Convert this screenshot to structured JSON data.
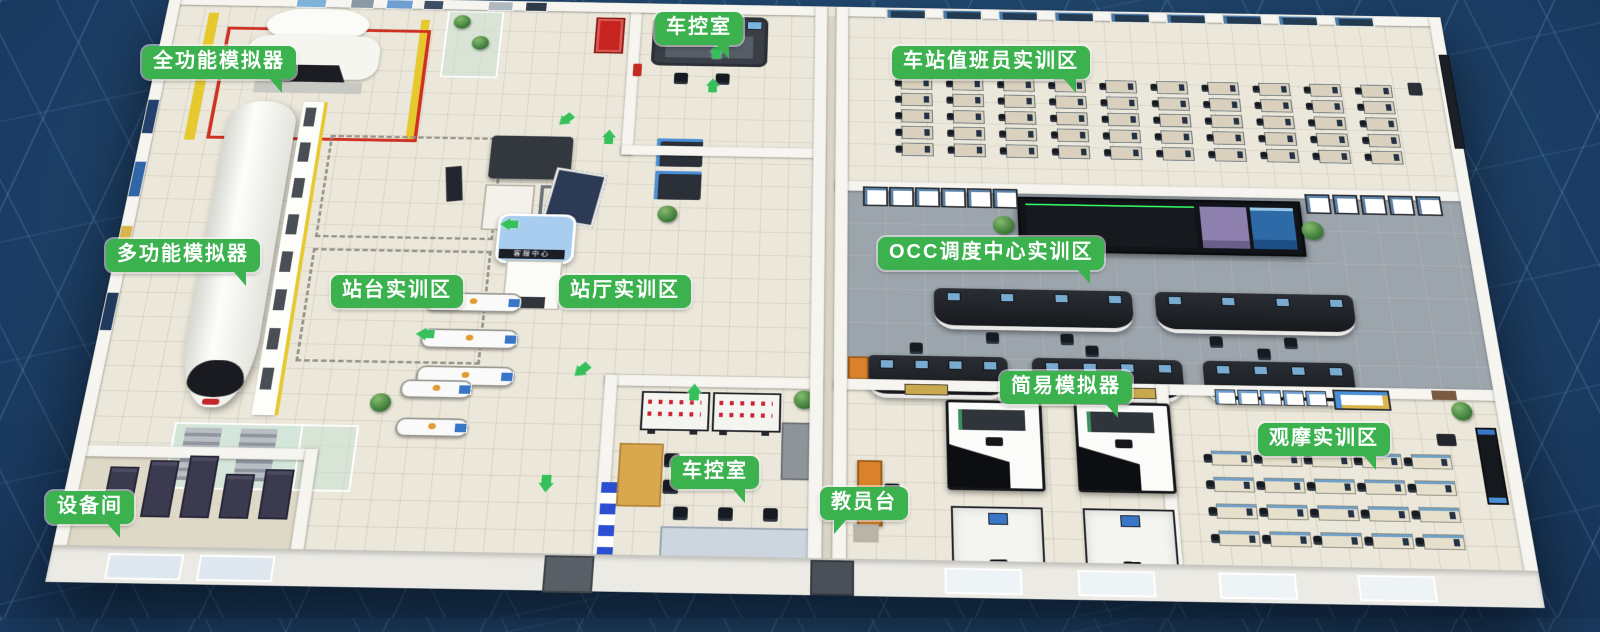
{
  "scene": {
    "description_labels_language": "zh-CN",
    "kiosk_sign": "客服中心"
  },
  "colors": {
    "background_navy": "#1c3f66",
    "background_line": "#7aaad7",
    "label_green": "#3bb24e",
    "arrow_green": "#35c05a",
    "wall_white": "#f6f5f0",
    "floor_beige": "#ebe7da",
    "occ_carpet_gray": "#9ca4ac",
    "marking_yellow": "#e6c92e",
    "marking_red": "#d03022",
    "kiosk_roof_blue": "#a9cdee",
    "instructor_desk_orange": "#d9822b"
  },
  "labels": [
    {
      "id": "full-function-simulator",
      "text": "全功能模拟器",
      "x": 142,
      "y": 46,
      "tail": "br"
    },
    {
      "id": "train-control-room-top",
      "text": "车控室",
      "x": 655,
      "y": 12,
      "tail": "br"
    },
    {
      "id": "station-attendant-training-area",
      "text": "车站值班员实训区",
      "x": 892,
      "y": 46,
      "tail": "br"
    },
    {
      "id": "multi-function-simulator",
      "text": "多功能模拟器",
      "x": 106,
      "y": 239,
      "tail": "br"
    },
    {
      "id": "platform-training-area",
      "text": "站台实训区",
      "x": 331,
      "y": 275,
      "tail": "none"
    },
    {
      "id": "station-hall-training-area",
      "text": "站厅实训区",
      "x": 559,
      "y": 275,
      "tail": "none"
    },
    {
      "id": "occ-dispatch-center-training-area",
      "text": "OCC调度中心实训区",
      "x": 878,
      "y": 237,
      "tail": "br"
    },
    {
      "id": "simple-simulator",
      "text": "简易模拟器",
      "x": 1000,
      "y": 371,
      "tail": "br"
    },
    {
      "id": "observation-training-area",
      "text": "观摩实训区",
      "x": 1258,
      "y": 423,
      "tail": "br"
    },
    {
      "id": "train-control-room-bottom",
      "text": "车控室",
      "x": 671,
      "y": 456,
      "tail": "br"
    },
    {
      "id": "instructor-station",
      "text": "教员台",
      "x": 820,
      "y": 487,
      "tail": "bl"
    },
    {
      "id": "equipment-room",
      "text": "设备间",
      "x": 46,
      "y": 491,
      "tail": "br"
    }
  ],
  "icons": {
    "floor_arrow": "wayfinding-direction-arrow",
    "plant": "potted-plant",
    "gate_sign": "fare-gate-direction-sign"
  },
  "floor_arrows": [
    {
      "x": 480,
      "y": 168,
      "rot": 225
    },
    {
      "x": 530,
      "y": 192,
      "rot": 0
    },
    {
      "x": 645,
      "y": 118,
      "rot": 0
    },
    {
      "x": 648,
      "y": 70,
      "rot": 0
    },
    {
      "x": 428,
      "y": 310,
      "rot": 270
    },
    {
      "x": 520,
      "y": 490,
      "rot": 225
    },
    {
      "x": 640,
      "y": 515,
      "rot": 0
    },
    {
      "x": 492,
      "y": 622,
      "rot": 180
    },
    {
      "x": 350,
      "y": 450,
      "rot": 270
    }
  ],
  "furniture": {
    "duty_desk_grid": {
      "cols": 10,
      "rows": 5
    },
    "observe_desk_grid": {
      "cols": 5,
      "rows": 4
    },
    "server_racks": 5,
    "simulator_booths": 4,
    "occ_console_row1": 2,
    "occ_console_row2": 3,
    "fare_gates_row1": 3,
    "fare_gates_row2": 2,
    "ibp_panels": 2
  }
}
